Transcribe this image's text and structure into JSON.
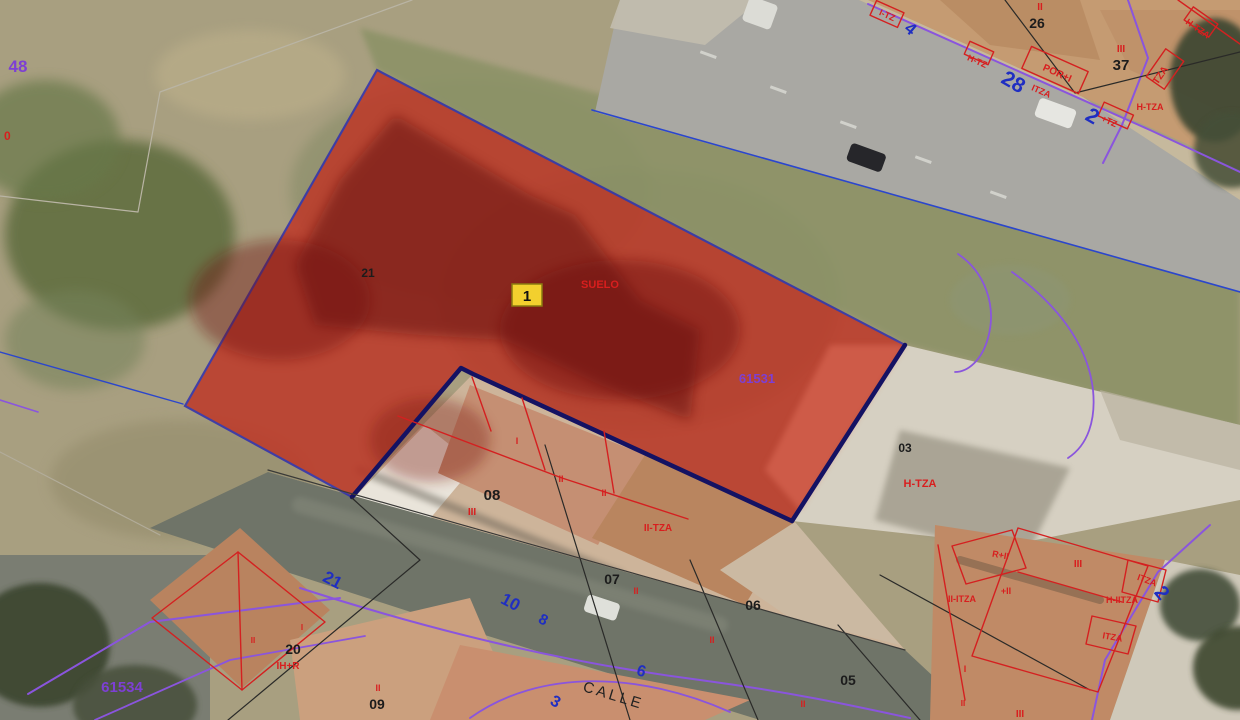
{
  "map": {
    "badge": {
      "label": "1"
    },
    "street": {
      "name": "CALLE"
    },
    "parcels": {
      "p21": "21",
      "p26": "26",
      "p37": "37",
      "p03": "03",
      "p08": "08",
      "p07": "07",
      "p06": "06",
      "p05": "05",
      "p09": "09",
      "p20": "20"
    },
    "blocks": {
      "center": "61531",
      "bottom_left": "61534",
      "top_left": "48"
    },
    "street_numbers": {
      "n4": "4",
      "n28": "28",
      "n2_top": "2",
      "n21": "21",
      "n10": "10",
      "n8": "8",
      "n6": "6",
      "n3": "3",
      "n2_right": "2"
    },
    "labels": {
      "suelo": "SUELO",
      "h_tza": "H-TZA",
      "ii_tza": "II-TZA",
      "por_i": "POR+I",
      "tza": "TZA",
      "itza": "ITZA",
      "h_iitza": "H-IITZA",
      "ii_itza": "II-ITZA",
      "r_ii": "R+II",
      "ih_r": "IH+R",
      "h_tz": "H-TZ",
      "plus_tz": "+TZ",
      "plus_ii": "+II",
      "i_tz": "I-TZ",
      "rom_i": "I",
      "rom_ii": "II",
      "rom_iii": "III",
      "zero": "0"
    },
    "colors": {
      "selection_fill": "#bf3425",
      "boundary_navy": "#141263",
      "cadastral_red": "#d42020",
      "block_purple": "#7d3fd4",
      "street_number_blue": "#1f2ec2",
      "badge_yellow": "#f2d02e"
    }
  }
}
